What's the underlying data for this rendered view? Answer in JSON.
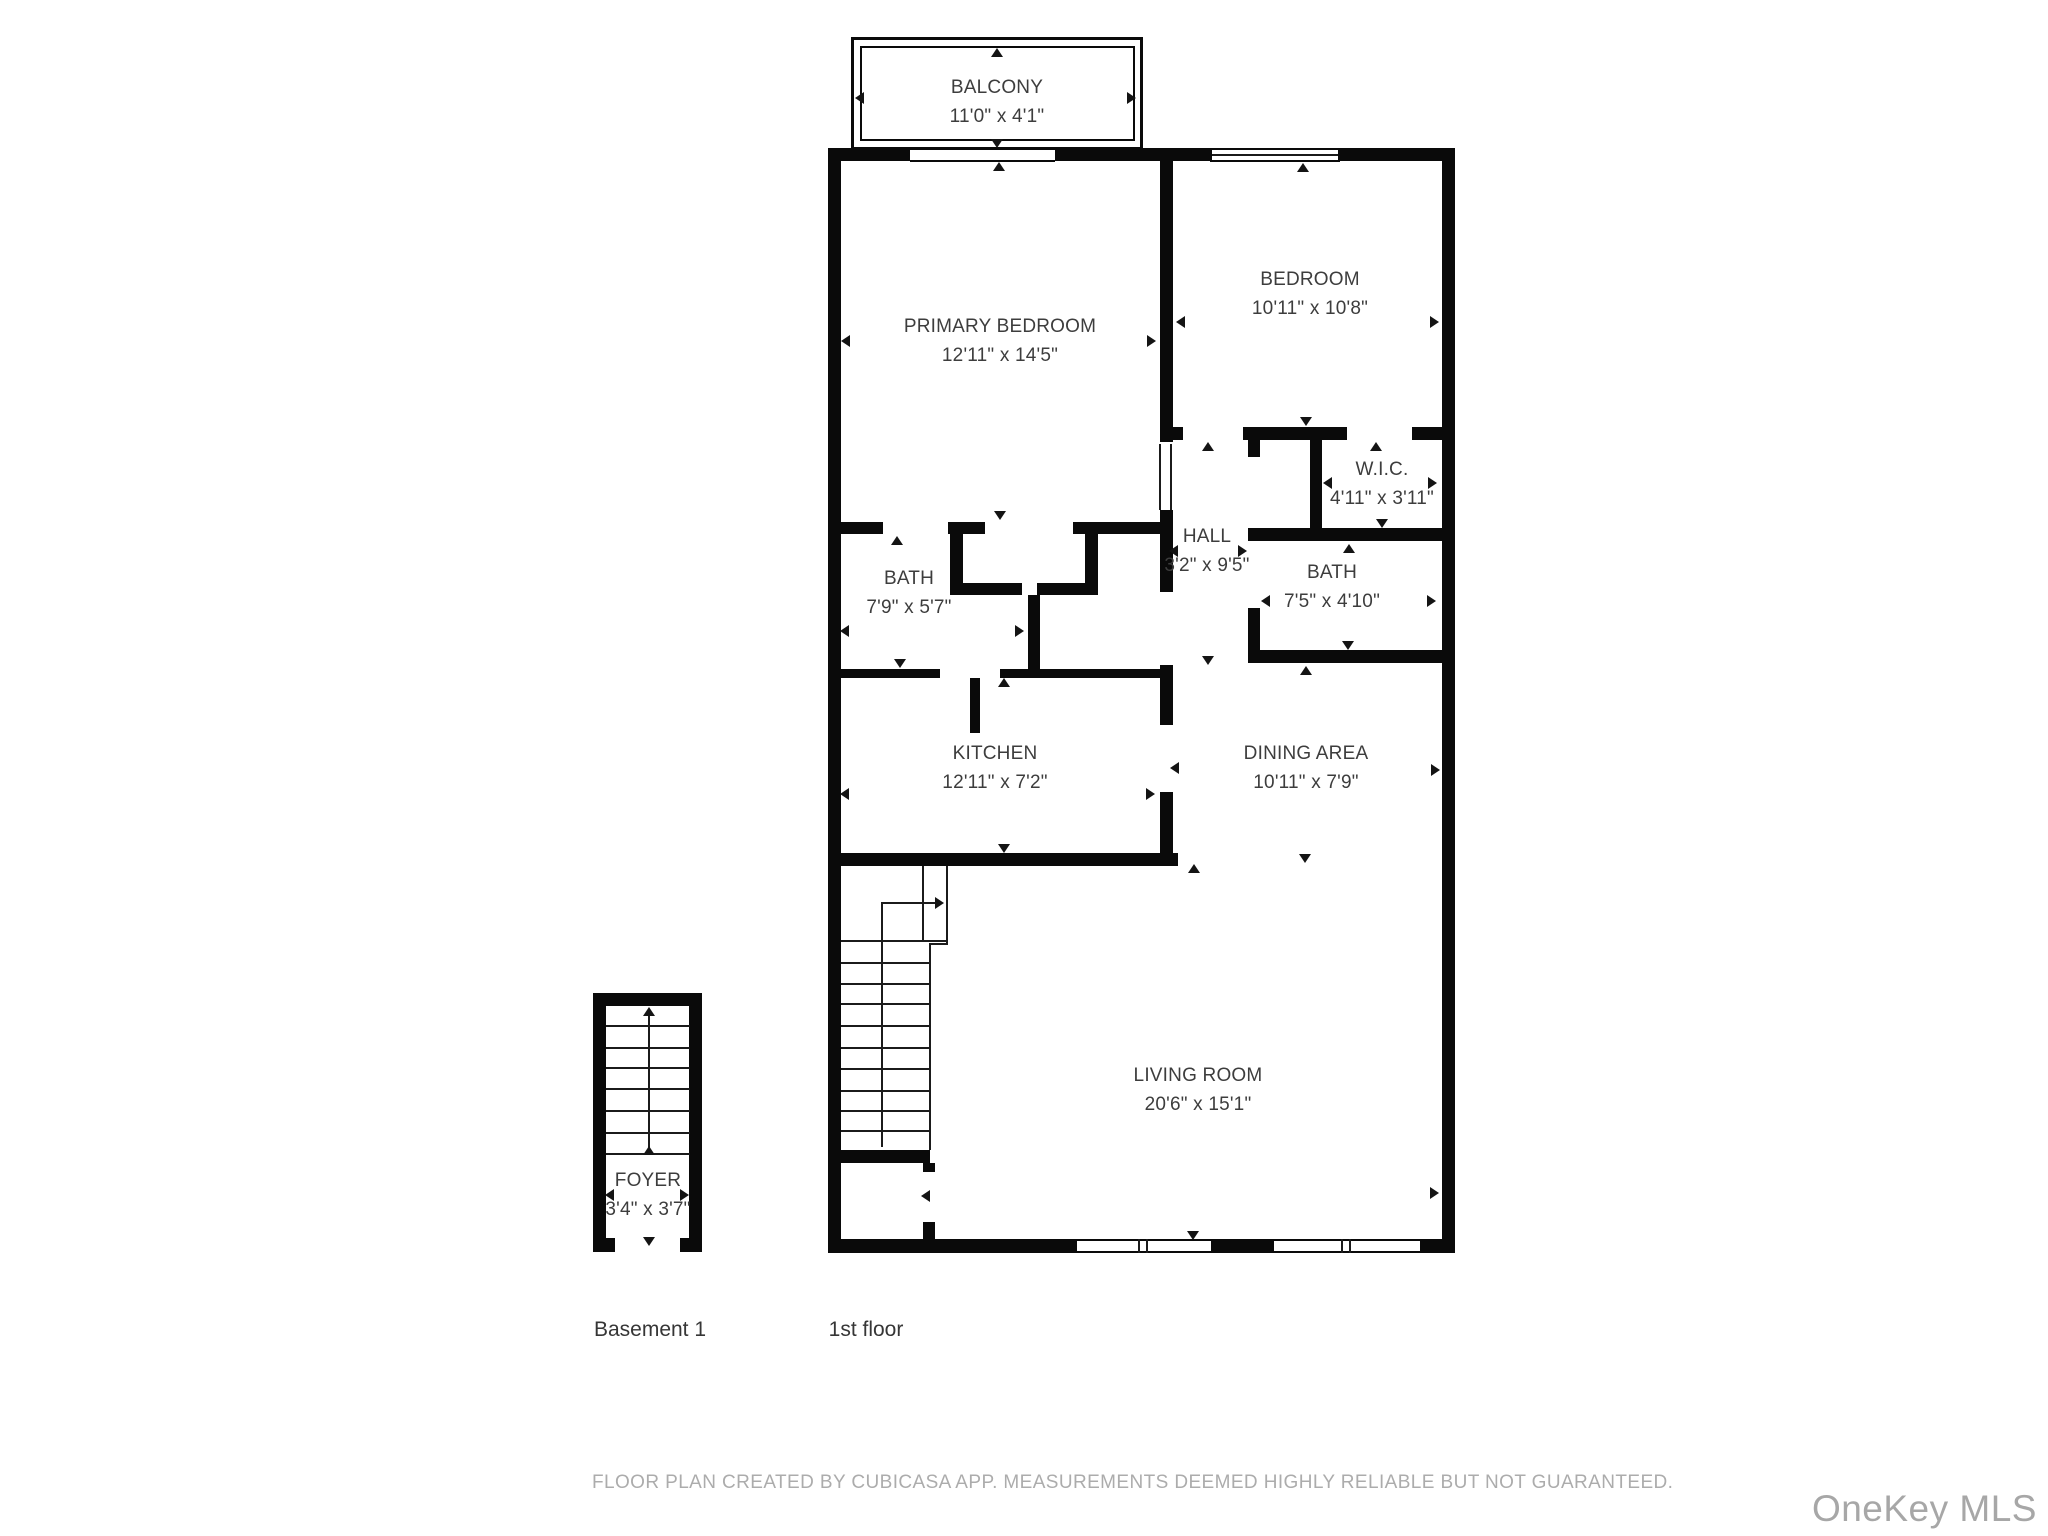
{
  "floor_plan": {
    "rooms": [
      {
        "name": "BALCONY",
        "dims": "11'0\" x 4'1\""
      },
      {
        "name": "PRIMARY BEDROOM",
        "dims": "12'11\" x 14'5\""
      },
      {
        "name": "BEDROOM",
        "dims": "10'11\" x 10'8\""
      },
      {
        "name": "W.I.C.",
        "dims": "4'11\" x 3'11\""
      },
      {
        "name": "HALL",
        "dims": "3'2\" x 9'5\""
      },
      {
        "name": "BATH",
        "dims": "7'9\" x 5'7\""
      },
      {
        "name": "BATH",
        "dims": "7'5\" x 4'10\""
      },
      {
        "name": "KITCHEN",
        "dims": "12'11\" x 7'2\""
      },
      {
        "name": "DINING AREA",
        "dims": "10'11\" x 7'9\""
      },
      {
        "name": "LIVING ROOM",
        "dims": "20'6\" x 15'1\""
      },
      {
        "name": "FOYER",
        "dims": "3'4\" x 3'7\""
      }
    ],
    "floor_labels": [
      {
        "label": "Basement 1"
      },
      {
        "label": "1st floor"
      }
    ],
    "footer": "FLOOR PLAN CREATED BY CUBICASA APP. MEASUREMENTS DEEMED HIGHLY RELIABLE BUT NOT GUARANTEED.",
    "watermark": "OneKey MLS",
    "colors": {
      "wall": "#0a0a0a",
      "label_text": "#3d3d3d",
      "footer_text": "#acacac",
      "watermark_text": "#a7a7a7"
    }
  }
}
